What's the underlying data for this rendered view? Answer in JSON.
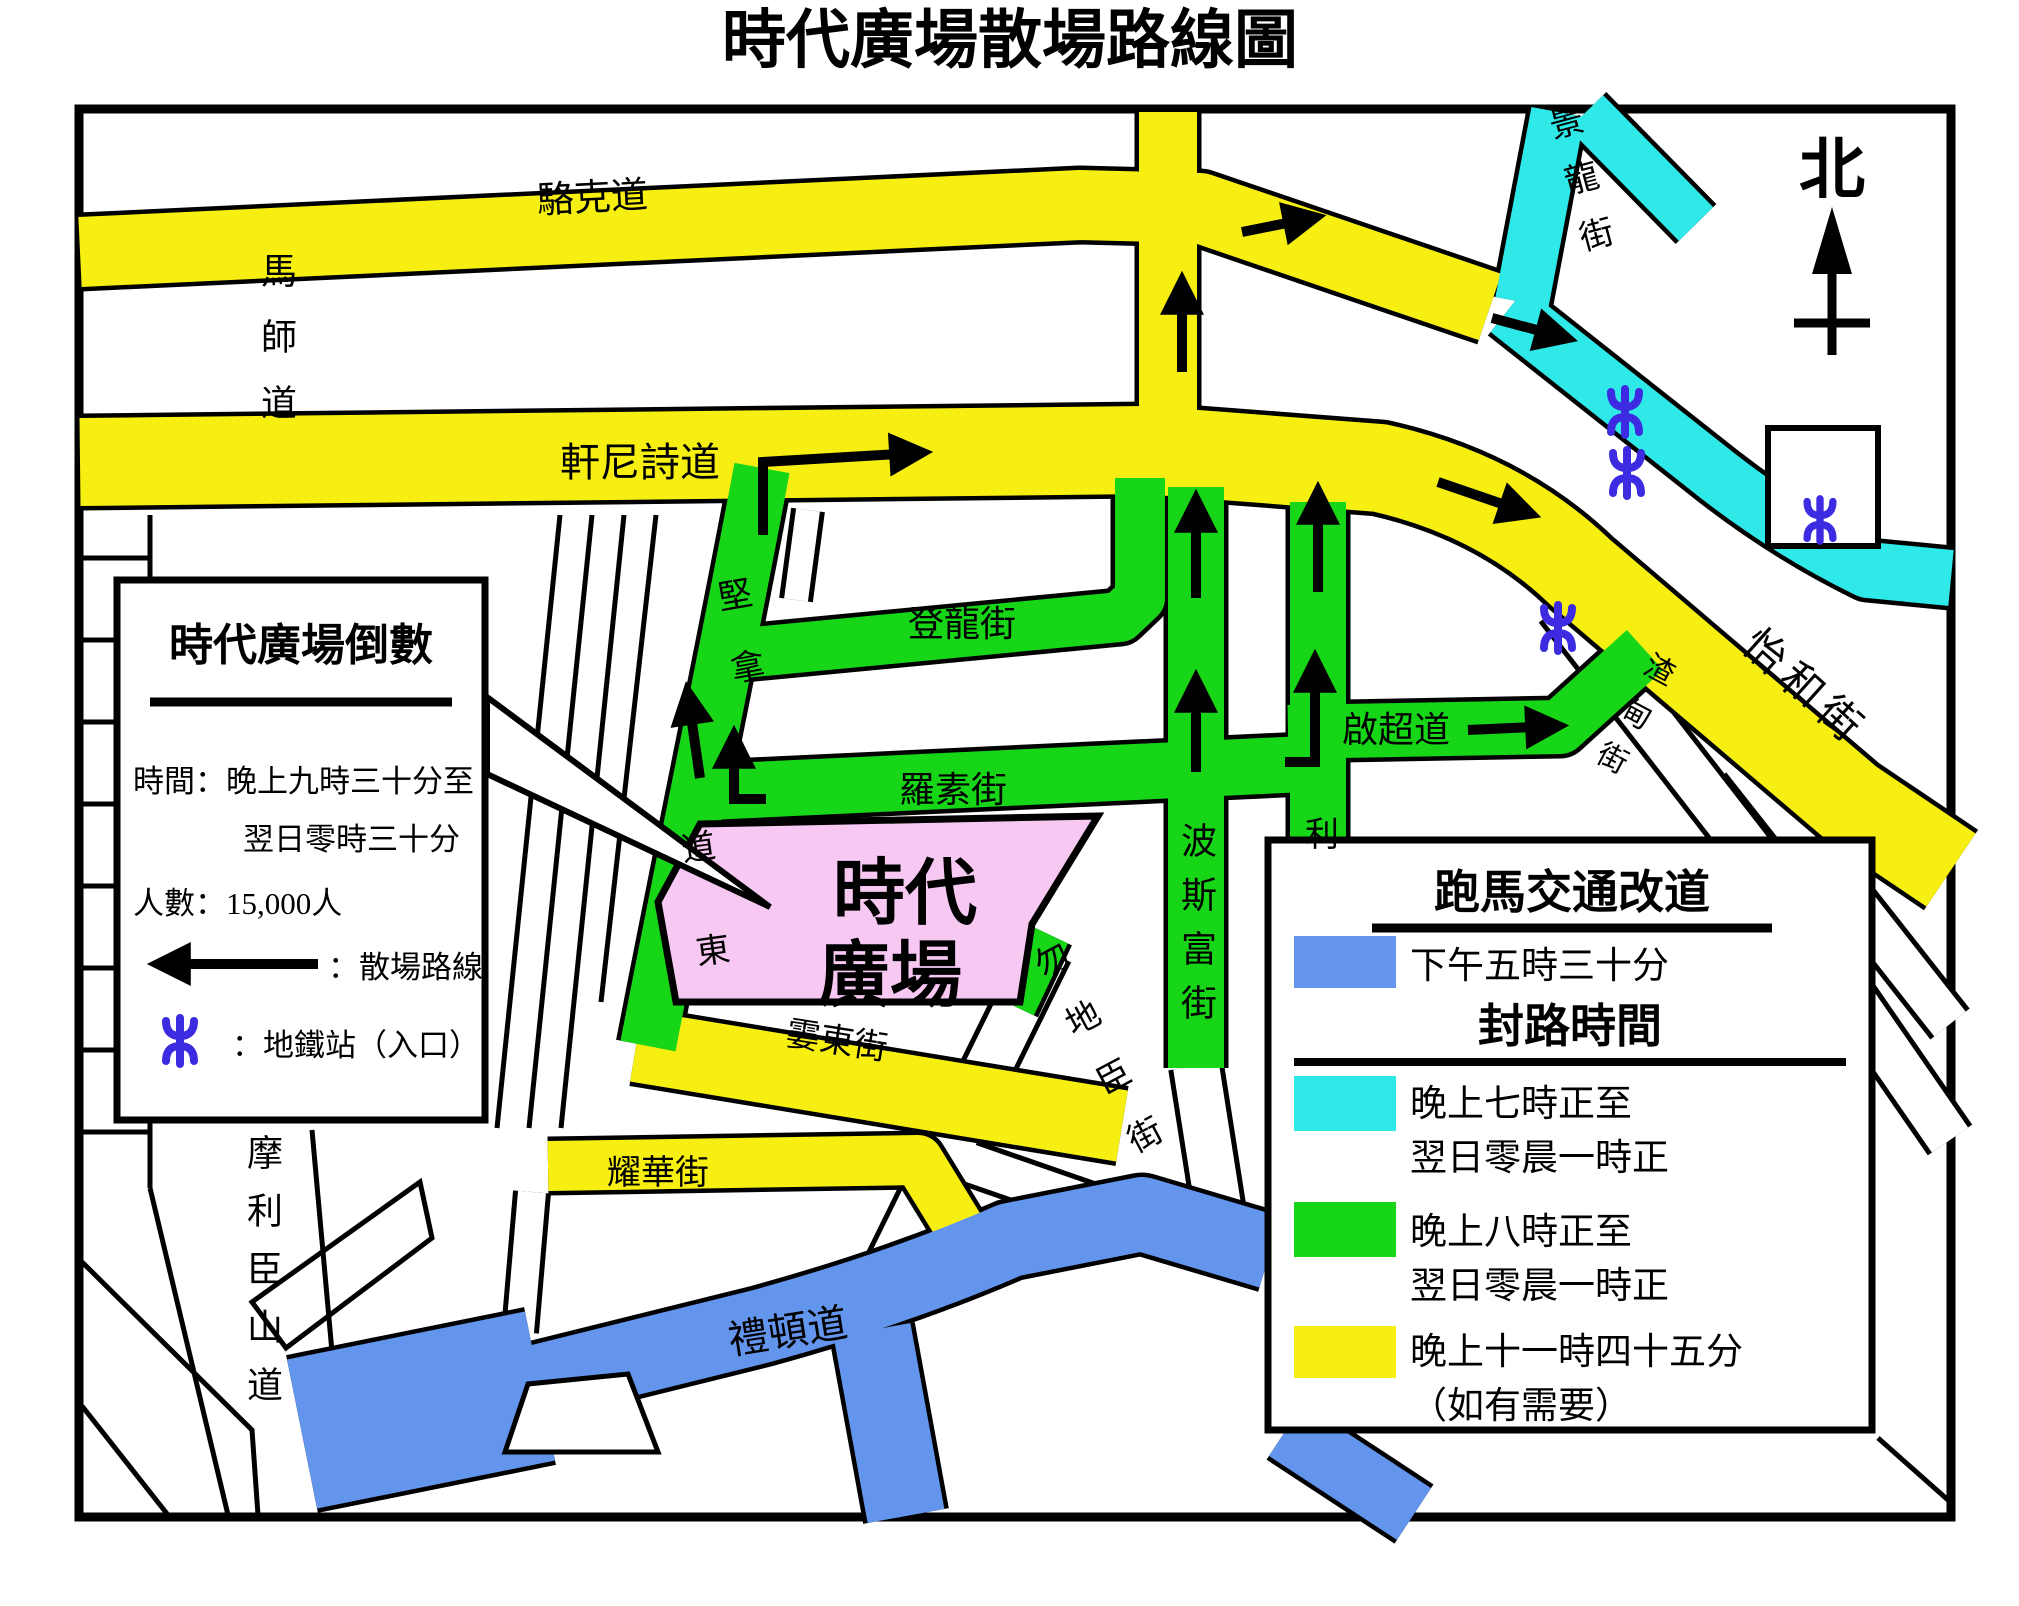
{
  "title": "時代廣場散場路線圖",
  "north": "北",
  "colors": {
    "yellow": "#f7ef12",
    "green": "#17d517",
    "cyan": "#2fe8e8",
    "blue": "#6495ed",
    "pink": "#f6c8f2",
    "mtr": "#3c2be0"
  },
  "streets": {
    "lockhart": "駱克道",
    "marsh": "馬師道",
    "hennessy": "軒尼詩道",
    "king_lung": "景龍街",
    "yee_wo": "怡和街",
    "jardines": "渣甸街",
    "tang_lung": "登龍街",
    "russell": "羅素街",
    "kai_chiu": "啟超道",
    "percival": "波斯富街",
    "lee_garden": "利",
    "canal_east_1": "堅拿",
    "canal_east_2": "道東",
    "sharp_east": "霎東街",
    "yiu_wa": "耀華街",
    "matheson": "勿地臣街",
    "leighton": "禮頓道",
    "morrison_hill": "摩利臣山道"
  },
  "landmark": {
    "times_square_1": "時代",
    "times_square_2": "廣場"
  },
  "legend_left": {
    "title": "時代廣場倒數",
    "time_line1": "時間：晚上九時三十分至",
    "time_line2": "翌日零時三十分",
    "people": "人數：15,000人",
    "route": "：散場路線",
    "mtr": "：地鐵站（入口）"
  },
  "legend_right": {
    "title": "跑馬交通改道",
    "blue_label": "下午五時三十分",
    "subtitle": "封路時間",
    "cyan_line1": "晚上七時正至",
    "cyan_line2": "翌日零晨一時正",
    "green_line1": "晚上八時正至",
    "green_line2": "翌日零晨一時正",
    "yellow_line1": "晚上十一時四十五分",
    "yellow_line2": "（如有需要）"
  }
}
